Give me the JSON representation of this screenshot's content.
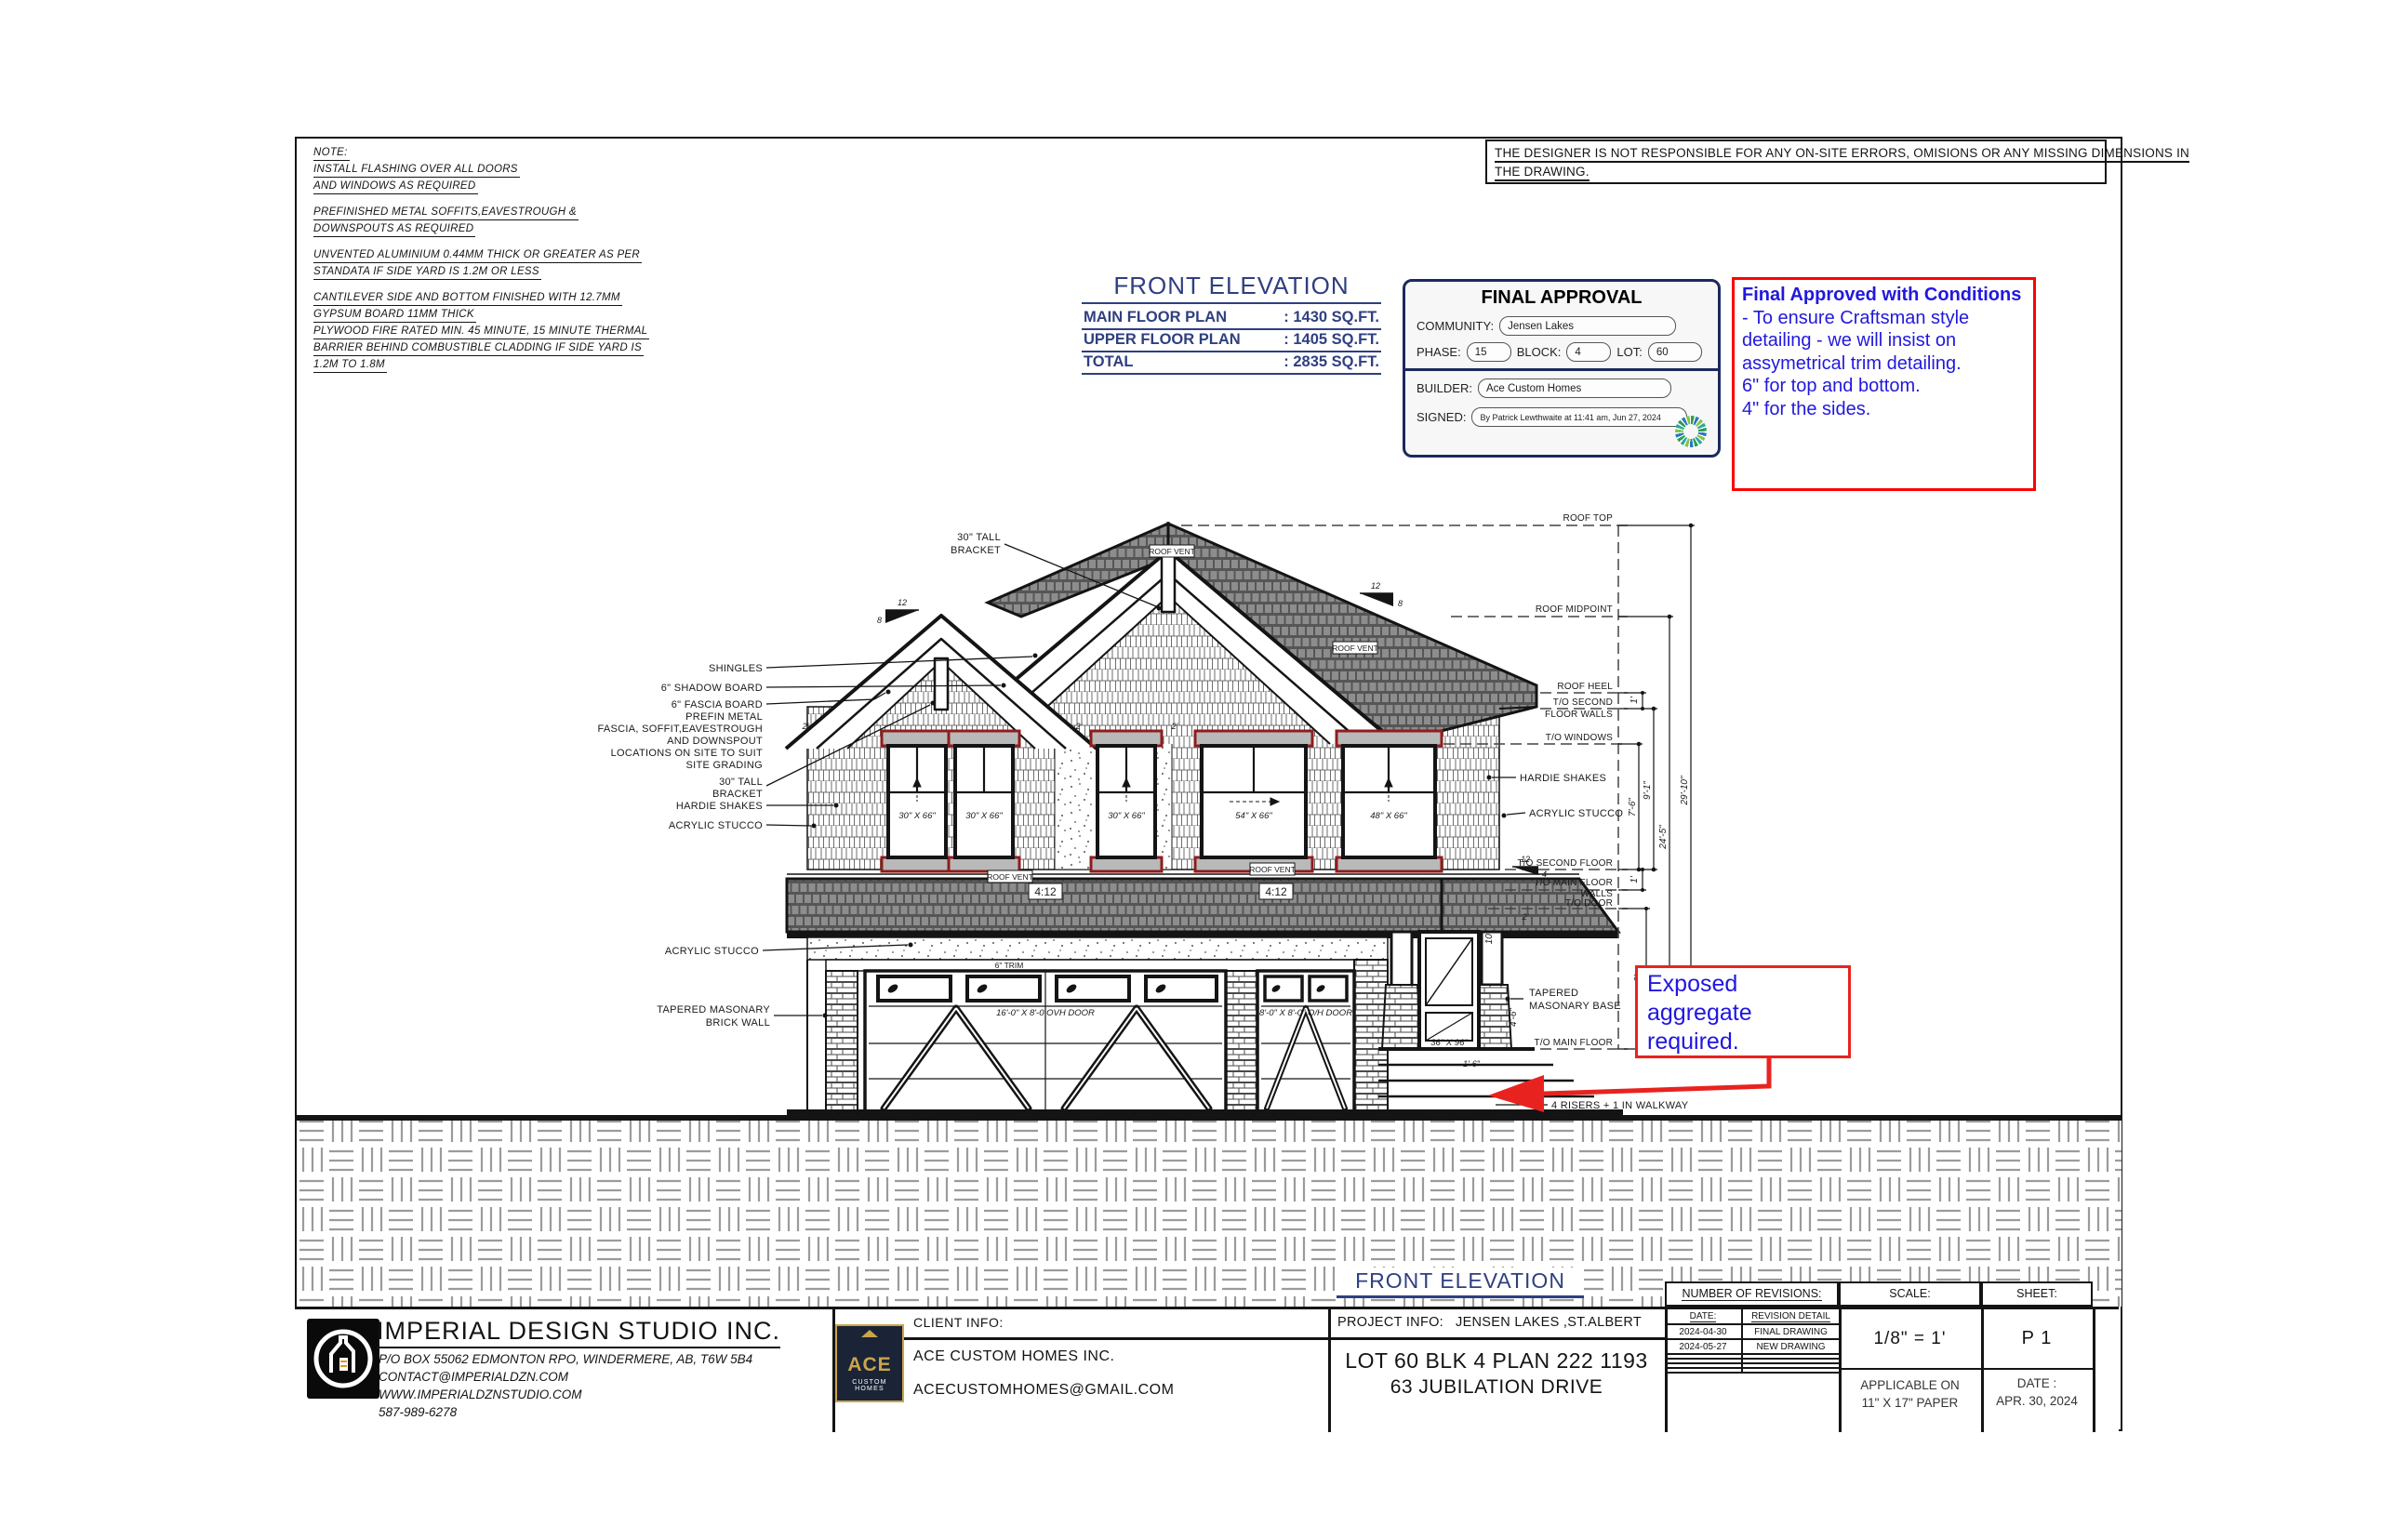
{
  "colors": {
    "line_black": "#141414",
    "accent_blue": "#2f3f80",
    "annotation_blue": "#2218dd",
    "stamp_navy": "#1b2a5e",
    "alert_red": "#ff0000",
    "trim_maroon": "#8f1d1d",
    "roof_gray": "#6e6e6e"
  },
  "notes": {
    "title": "NOTE:",
    "p1": [
      "INSTALL FLASHING OVER ALL DOORS",
      "AND WINDOWS AS REQUIRED"
    ],
    "p2": [
      "PREFINISHED METAL SOFFITS,EAVESTROUGH &",
      "DOWNSPOUTS AS REQUIRED"
    ],
    "p3": [
      "UNVENTED ALUMINIUM 0.44MM THICK OR GREATER AS PER",
      "STANDATA IF SIDE YARD IS 1.2M OR LESS"
    ],
    "p4": [
      "CANTILEVER SIDE AND BOTTOM FINISHED WITH 12.7MM",
      "GYPSUM BOARD 11MM THICK",
      "PLYWOOD FIRE RATED MIN. 45 MINUTE, 15 MINUTE THERMAL",
      "BARRIER BEHIND COMBUSTIBLE CLADDING IF SIDE YARD IS",
      "1.2M TO 1.8M"
    ]
  },
  "disclaimer": {
    "line1": "THE DESIGNER IS NOT RESPONSIBLE  FOR ANY ON-SITE ERRORS, OMISIONS OR ANY MISSING DIMENSIONS IN",
    "line2": "THE DRAWING."
  },
  "elevation_summary": {
    "title": "FRONT ELEVATION",
    "rows": [
      {
        "label": "MAIN FLOOR PLAN",
        "value": ": 1430 SQ.FT."
      },
      {
        "label": "UPPER FLOOR PLAN",
        "value": ": 1405 SQ.FT."
      },
      {
        "label": "TOTAL",
        "value": ": 2835 SQ.FT."
      }
    ]
  },
  "approval": {
    "title": "FINAL APPROVAL",
    "community_label": "COMMUNITY:",
    "community_value": "Jensen Lakes",
    "phase_label": "PHASE:",
    "phase_value": "15",
    "block_label": "BLOCK:",
    "block_value": "4",
    "lot_label": "LOT:",
    "lot_value": "60",
    "builder_label": "BUILDER:",
    "builder_value": "Ace Custom Homes",
    "signed_label": "SIGNED:",
    "signed_value": "By Patrick Lewthwaite at 11:41 am, Jun 27, 2024"
  },
  "conditions": {
    "bold": "Final Approved with Conditions",
    "rest": " - To ensure Craftsman style detailing - we will insist on assymetrical trim detailing.",
    "line2": "6\" for top and bottom.",
    "line3": "4\" for the sides."
  },
  "drawing": {
    "callouts": {
      "bracket_top_1": "30\" TALL",
      "bracket_top_2": "BRACKET",
      "shingles": "SHINGLES",
      "shadow_board": "6\" SHADOW BOARD",
      "fascia_1": "6\" FASCIA BOARD",
      "fascia_2": "PREFIN METAL",
      "fascia_3": "FASCIA, SOFFIT,EAVESTROUGH",
      "fascia_4": "AND DOWNSPOUT",
      "fascia_5": "LOCATIONS ON SITE TO SUIT",
      "fascia_6": "SITE GRADING",
      "bracket_left_1": "30\" TALL",
      "bracket_left_2": "BRACKET",
      "hardie_left": "HARDIE SHAKES",
      "stucco_left": "ACRYLIC STUCCO",
      "stucco_left2": "ACRYLIC STUCCO",
      "masonry_left_1": "TAPERED MASONARY",
      "masonry_left_2": "BRICK WALL",
      "hardie_right": "HARDIE SHAKES",
      "stucco_right": "ACRYLIC STUCCO",
      "masonry_right_1": "TAPERED",
      "masonry_right_2": "MASONARY BASE",
      "stairs": "4 RISERS + 1 IN WALKWAY"
    },
    "levels": {
      "roof_top": "ROOF TOP",
      "roof_midpoint": "ROOF MIDPOINT",
      "roof_heel": "ROOF HEEL",
      "to_second_1": "T/O SECOND",
      "to_second_2": "FLOOR WALLS",
      "to_windows": "T/O WINDOWS",
      "to_second_floor": "T/O SECOND FLOOR",
      "to_main_walls_1": "T/O MAIN FLOOR",
      "to_main_walls_2": "WALLS",
      "to_door": "T/O DOOR",
      "to_main_floor": "T/O MAIN FLOOR"
    },
    "dims": {
      "total": "29'-10\"",
      "midpoint": "24'-5\"",
      "second": "9'-1\"",
      "windows": "7'-6\"",
      "one_a": "1'",
      "one_b": "1'",
      "door_h": "8'",
      "eave_a": "2'",
      "eave_b": "2'",
      "eave_c": "2'",
      "eave_d": "2'",
      "post": "10\"",
      "base": "4'-6\"",
      "step": "1'-6\""
    },
    "slopes": {
      "twelve": "12",
      "eight": "8",
      "four": "4",
      "four_twelve": "4:12"
    },
    "labels": {
      "roof_vent": "ROOF VENT",
      "w30": "30\" X 66\"",
      "w54": "54\" X 66\"",
      "w48": "48\" X 66\"",
      "entry_door": "36\" X 96\"",
      "garage1": "16'-0\" X 8'-0 OVH DOOR",
      "garage2": "8'-0\" X 8'-0\" O/H DOOR",
      "trim": "6\" TRIM"
    },
    "exposed_note": {
      "line1": "Exposed",
      "line2": "aggregate",
      "line3": "required."
    },
    "bottom_label": "FRONT ELEVATION"
  },
  "title_block": {
    "imperial": {
      "name": "IMPERIAL DESIGN STUDIO INC.",
      "address": "P/O BOX 55062 EDMONTON RPO, WINDERMERE, AB, T6W 5B4",
      "email": "CONTACT@IMPERIALDZN.COM",
      "website": "WWW.IMPERIALDZNSTUDIO.COM",
      "phone": "587-989-6278"
    },
    "client": {
      "header": "CLIENT INFO:",
      "name": "ACE CUSTOM HOMES INC.",
      "email": "ACECUSTOMHOMES@GMAIL.COM",
      "logo_line1": "ACE",
      "logo_line2": "CUSTOM HOMES"
    },
    "project": {
      "header_label": "PROJECT INFO:",
      "header_value": "JENSEN LAKES ,ST.ALBERT",
      "line1": "LOT 60  BLK 4  PLAN 222 1193",
      "line2": "63 JUBILATION DRIVE"
    },
    "revisions": {
      "header": "NUMBER OF REVISIONS:",
      "col_date": "DATE:",
      "col_detail": "REVISION DETAIL",
      "rows": [
        {
          "date": "2024-04-30",
          "detail": "FINAL DRAWING"
        },
        {
          "date": "2024-05-27",
          "detail": "NEW DRAWING"
        },
        {
          "date": "",
          "detail": ""
        },
        {
          "date": "",
          "detail": ""
        },
        {
          "date": "",
          "detail": ""
        },
        {
          "date": "",
          "detail": ""
        }
      ]
    },
    "scale": {
      "header": "SCALE:",
      "value": "1/8\"  =  1'",
      "paper_line1": "APPLICABLE ON",
      "paper_line2": "11\" X 17\" PAPER"
    },
    "sheet": {
      "header": "SHEET:",
      "value": "P 1",
      "date_label": "DATE :",
      "date_value": "APR. 30, 2024"
    }
  }
}
